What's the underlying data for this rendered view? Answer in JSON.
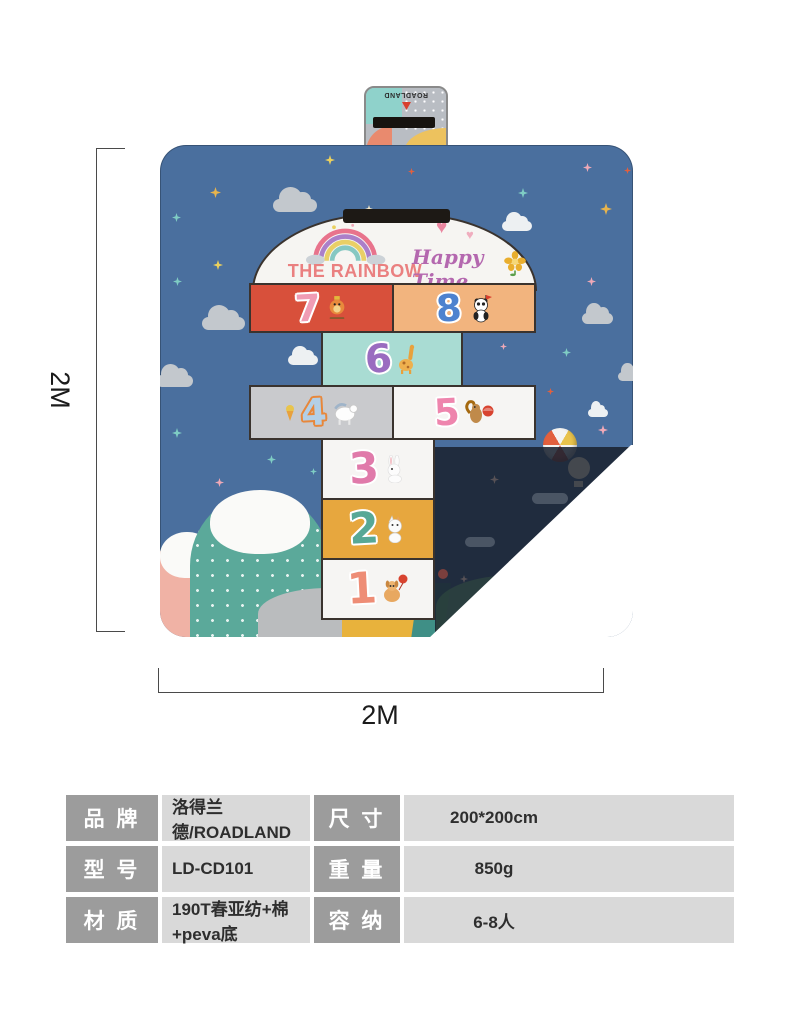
{
  "product": {
    "brand_tag": {
      "brand": "ROADLAND"
    },
    "mat": {
      "header": {
        "left_title": "THE RAINBOW",
        "right_title": "Happy Time"
      },
      "cells": [
        {
          "number": "7",
          "animal": "bird",
          "cell_color": "#d8503b"
        },
        {
          "number": "8",
          "animal": "panda",
          "cell_color": "#f2b47e"
        },
        {
          "number": "6",
          "animal": "giraffe",
          "cell_color": "#a9dcd3"
        },
        {
          "number": "4",
          "animal": "horse",
          "cell_color": "#c9cacd"
        },
        {
          "number": "5",
          "animal": "squirrel",
          "cell_color": "#f6f5f3"
        },
        {
          "number": "3",
          "animal": "rabbit",
          "cell_color": "#f6f5f3"
        },
        {
          "number": "2",
          "animal": "cat",
          "cell_color": "#e7a73e"
        },
        {
          "number": "1",
          "animal": "dog",
          "cell_color": "#f6f5f3"
        }
      ],
      "colors": {
        "mat_blue": "#4a6f9e",
        "underside_dark": "#1a2230",
        "mountain_teal": "#5ba99a",
        "mountain_pink": "#f0b2a5",
        "hill_gray": "#babcbe"
      }
    },
    "dimensions": {
      "height": "2M",
      "width": "2M"
    }
  },
  "spec_table": {
    "colors": {
      "label_bg": "#9c9c9c",
      "value_bg": "#d9d9d9"
    },
    "cells": [
      {
        "label": "品 牌",
        "value": "洛得兰德/ROADLAND"
      },
      {
        "label": "尺 寸",
        "value": "200*200cm"
      },
      {
        "label": "型 号",
        "value": "LD-CD101"
      },
      {
        "label": "重 量",
        "value": "850g"
      },
      {
        "label": "材 质",
        "value": "190T春亚纺+棉+peva底"
      },
      {
        "label": "容 纳",
        "value": "6-8人"
      }
    ]
  }
}
